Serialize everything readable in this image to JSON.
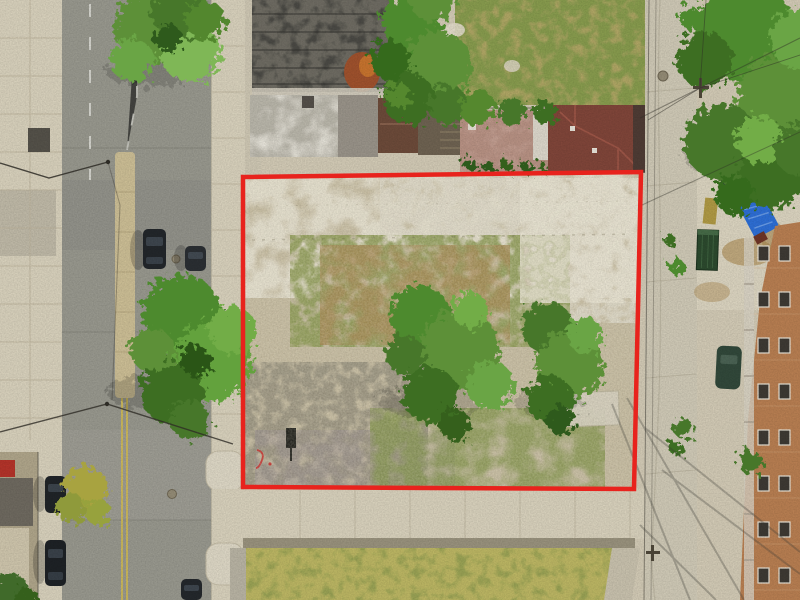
{
  "meta": {
    "type": "aerial-drone-photograph",
    "description": "Overhead aerial photo of a vacant urban corner lot outlined with a thick red property boundary; street with parked cars on the left, concrete alley with utility wires on the right, commercial rooftops and a hip-roof house above, sidewalk and a grassy parcel below, brick apartment building at lower right, leafy green trees throughout.",
    "width": 800,
    "height": 600
  },
  "boundary": {
    "label": "property-boundary",
    "color": "#e8231d",
    "stroke_width": 4.5,
    "corners": {
      "top_left": [
        243,
        177
      ],
      "top_right": [
        641,
        172
      ],
      "bottom_right": [
        634,
        489
      ],
      "bottom_left": [
        243,
        487
      ]
    }
  },
  "palette": {
    "concrete": "#d3cbb6",
    "concrete_light": "#dcd5c1",
    "sidewalk": "#d9d2bd",
    "asphalt": "#99998f",
    "median_tan": "#cdbf96",
    "lot_dirt": "#c6bca1",
    "lot_pale": "#e6e1d0",
    "weeds_green": "#8c9a52",
    "rubble_gray": "#98927f",
    "dirt_brown": "#a78b55",
    "grass_green": "#9aa355",
    "grass_yellow": "#b0a765",
    "tree_green": "#5d9038",
    "tree_light": "#7fb757",
    "tree_dark": "#3c6e22",
    "roof_dark": "#4b4a45",
    "roof_white": "#e9e6dc",
    "roof_red": "#81463a",
    "shed_brown": "#6d4b3a",
    "patio_pink": "#c4a093",
    "brick": "#b97f52",
    "alley": "#d0cab7",
    "tarp_blue": "#2e6fd6",
    "dumpster_green": "#2c4a2e",
    "car_dark": "#23272b",
    "car_green": "#32493b",
    "yellow_line": "#d9c04e",
    "white_marking": "#e8e8e2",
    "wire": "#2e2c26",
    "awning_red": "#b5342a"
  },
  "objects": [
    {
      "name": "property-boundary",
      "label": "red outlined vacant lot"
    },
    {
      "name": "vacant-lot",
      "label": "cleared dirt lot with weeds and rubble"
    },
    {
      "name": "street-left",
      "label": "city street with median and parked cars"
    },
    {
      "name": "alley-right",
      "label": "concrete alley with utility poles and wires"
    },
    {
      "name": "building-dark-roof",
      "label": "commercial rooftop"
    },
    {
      "name": "house-red-roof",
      "label": "hip roof house"
    },
    {
      "name": "brick-apartment-building",
      "label": "brick apartment block"
    },
    {
      "name": "blue-tarp-truck",
      "label": "blue tarped vehicle"
    },
    {
      "name": "dumpster",
      "label": "green dumpster"
    },
    {
      "name": "tree-canopy",
      "label": "green trees"
    },
    {
      "name": "grass-parcel",
      "label": "grassy lot below sidewalk"
    }
  ]
}
